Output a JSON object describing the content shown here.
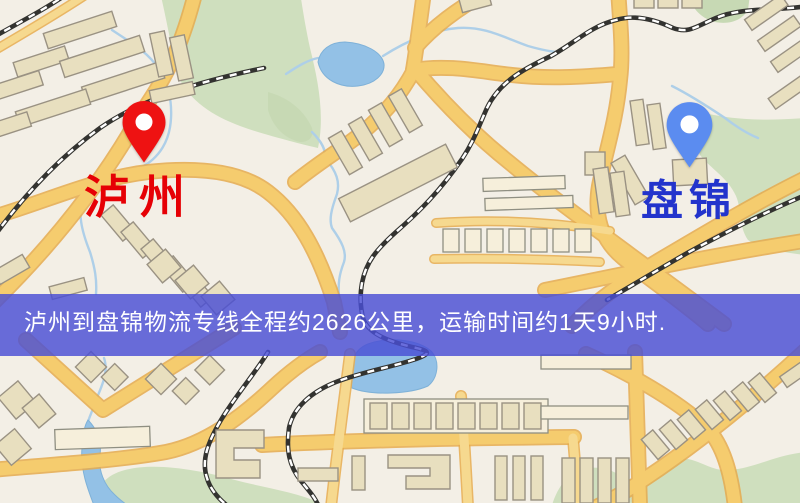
{
  "map": {
    "origin_city": "泸州",
    "destination_city": "盘锦",
    "origin_pin": "red-map-pin",
    "destination_pin": "blue-map-pin"
  },
  "route": {
    "origin": "泸州",
    "destination": "盘锦",
    "distance_text": "约2626公里",
    "duration_text": "约1天9小时"
  },
  "banner": {
    "text": "泸州到盘锦物流专线全程约2626公里，运输时间约1天9小时."
  },
  "colors": {
    "banner_bg": "rgba(73,78,212,0.82)",
    "banner_text": "#ffffff",
    "origin_pin": "#ee1212",
    "destination_pin": "#5b8cf0",
    "pin_hole": "#ffffff",
    "origin_label_color": "#e60005",
    "destination_label_color": "#2334cc",
    "road_color": "#f5cc6e",
    "water_color": "#93c1e6",
    "park_color": "#cfdfbe"
  }
}
